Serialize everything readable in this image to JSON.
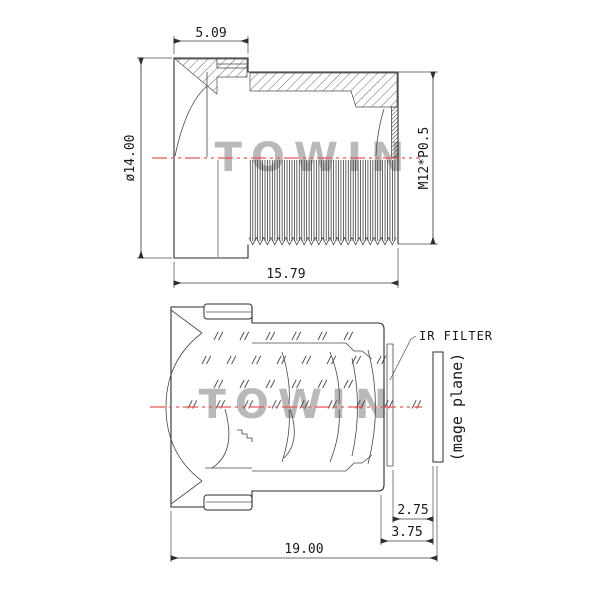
{
  "watermark": "TOWIN",
  "colors": {
    "line": "#2e2e2e",
    "centerline_red": "#ef5350",
    "watermark_gray": "#9f9f9f",
    "background": "#ffffff"
  },
  "top_view": {
    "name": "lens side cross-section",
    "dims": {
      "front_head_width": "5.09",
      "outer_diameter": "ø14.00",
      "thread_spec": "M12*P0.5",
      "barrel_length": "15.79"
    }
  },
  "bottom_view": {
    "name": "lens optical cross-section",
    "labels": {
      "ir_filter": "IR FILTER",
      "image_plane": "(mage plane)"
    },
    "dims": {
      "filter_to_image": "2.75",
      "rear_to_image": "3.75",
      "total_track": "19.00"
    }
  }
}
